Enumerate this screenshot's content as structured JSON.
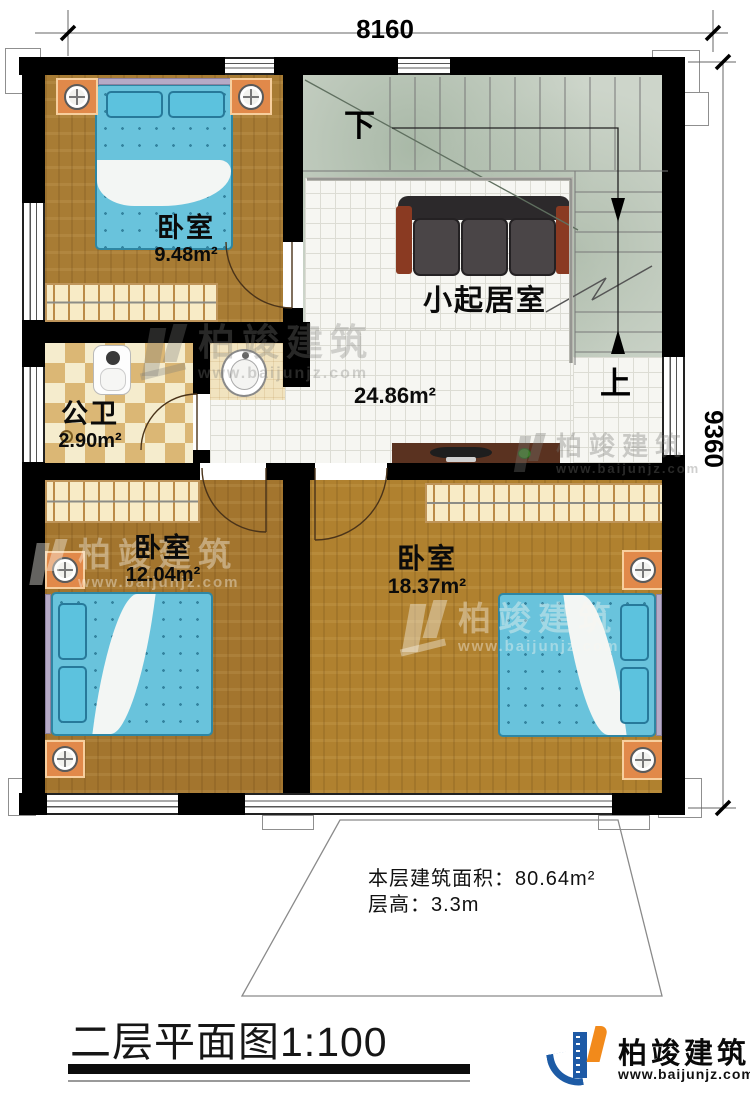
{
  "dimensions": {
    "top": "8160",
    "right": "9360"
  },
  "rooms": {
    "bedroom_top": {
      "name": "卧室",
      "area": "9.48m²"
    },
    "bathroom": {
      "name": "公卫",
      "area": "2.90m²"
    },
    "living": {
      "name": "小起居室",
      "area": "24.86m²"
    },
    "bedroom_left": {
      "name": "卧室",
      "area": "12.04m²"
    },
    "bedroom_right": {
      "name": "卧室",
      "area": "18.37m²"
    }
  },
  "stairs": {
    "down": "下",
    "up": "上"
  },
  "notes": {
    "area": "本层建筑面积：80.64m²",
    "height": "层高：3.3m"
  },
  "titleblock": {
    "title": "二层平面图",
    "scale": "1:100"
  },
  "brand": {
    "name": "柏竣建筑",
    "url": "www.baijunjz.com"
  },
  "watermark": {
    "name": "柏竣建筑",
    "url": "www.baijunjz.com"
  },
  "colors": {
    "wall": "#000000",
    "stair_floor": "#cdd5ca",
    "tile_floor": "#f6f6f2",
    "wood_floor": "#a87c34",
    "bath_tile": "#dbb775",
    "bed": "#69c3dc",
    "brand_blue": "#1d5ba5",
    "brand_orange": "#f28a1b"
  }
}
